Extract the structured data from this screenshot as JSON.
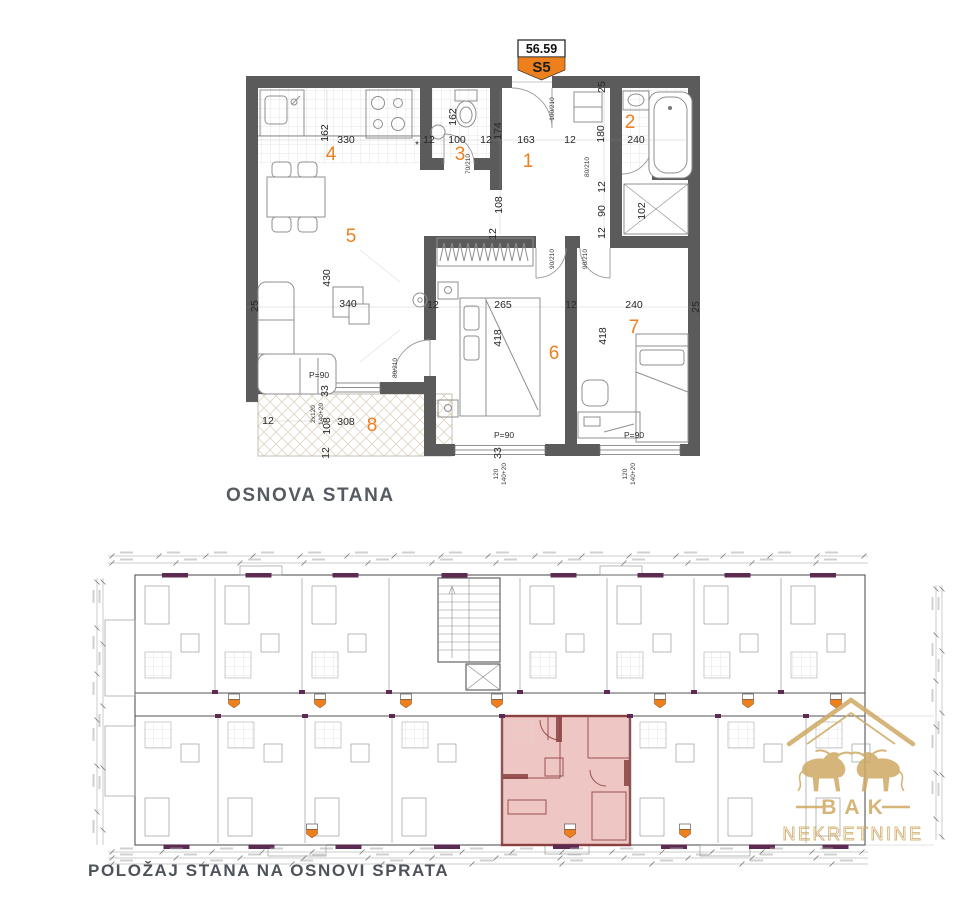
{
  "titles": {
    "plan": "OSNOVA STANA",
    "site": "POLOŽAJ STANA NA OSNOVI SPRATA"
  },
  "badge": {
    "area": "56.59",
    "unit": "S5"
  },
  "logo": {
    "name": "BAK",
    "subtitle": "NEKRETNINE"
  },
  "colors": {
    "accent_orange": "#ee7f1d",
    "wall_gray": "#5b5b5b",
    "highlight_pink": "#dd8e88",
    "highlight_wall": "#8a4040",
    "purple_accent": "#5d2b52",
    "logo_gold": "#cfa963",
    "title_gray": "#565a61"
  },
  "floorplan": {
    "labels": [
      {
        "t": "330",
        "x": 346,
        "y": 143,
        "k": "d"
      },
      {
        "t": "162",
        "x": 328,
        "y": 133,
        "k": "d",
        "r": 1
      },
      {
        "t": "*",
        "x": 417,
        "y": 148,
        "k": "d"
      },
      {
        "t": "12",
        "x": 429,
        "y": 143,
        "k": "d"
      },
      {
        "t": "100",
        "x": 457,
        "y": 143,
        "k": "d"
      },
      {
        "t": "12",
        "x": 486,
        "y": 143,
        "k": "d"
      },
      {
        "t": "162",
        "x": 456,
        "y": 117,
        "k": "d",
        "r": 1
      },
      {
        "t": "174",
        "x": 501,
        "y": 131,
        "k": "d",
        "r": 1
      },
      {
        "t": "163",
        "x": 526,
        "y": 143,
        "k": "d"
      },
      {
        "t": "25",
        "x": 605,
        "y": 87,
        "k": "d",
        "r": 1
      },
      {
        "t": "180",
        "x": 604,
        "y": 134,
        "k": "d",
        "r": 1
      },
      {
        "t": "240",
        "x": 636,
        "y": 143,
        "k": "d"
      },
      {
        "t": "12",
        "x": 570,
        "y": 143,
        "k": "d"
      },
      {
        "t": "12",
        "x": 605,
        "y": 187,
        "k": "d",
        "r": 1
      },
      {
        "t": "90",
        "x": 605,
        "y": 211,
        "k": "d",
        "r": 1
      },
      {
        "t": "12",
        "x": 605,
        "y": 233,
        "k": "d",
        "r": 1
      },
      {
        "t": "102",
        "x": 645,
        "y": 211,
        "k": "d",
        "r": 1
      },
      {
        "t": "108",
        "x": 502,
        "y": 205,
        "k": "d",
        "r": 1
      },
      {
        "t": "12",
        "x": 496,
        "y": 234,
        "k": "d",
        "r": 1
      },
      {
        "t": "25",
        "x": 258,
        "y": 306,
        "k": "d",
        "r": 1
      },
      {
        "t": "430",
        "x": 330,
        "y": 278,
        "k": "d",
        "r": 1
      },
      {
        "t": "340",
        "x": 348,
        "y": 307,
        "k": "d"
      },
      {
        "t": "12",
        "x": 433,
        "y": 308,
        "k": "d"
      },
      {
        "t": "265",
        "x": 503,
        "y": 308,
        "k": "d"
      },
      {
        "t": "12",
        "x": 571,
        "y": 308,
        "k": "d"
      },
      {
        "t": "240",
        "x": 634,
        "y": 308,
        "k": "d"
      },
      {
        "t": "25",
        "x": 699,
        "y": 307,
        "k": "d",
        "r": 1
      },
      {
        "t": "418",
        "x": 501,
        "y": 338,
        "k": "d",
        "r": 1
      },
      {
        "t": "418",
        "x": 606,
        "y": 336,
        "k": "d",
        "r": 1
      },
      {
        "t": "12",
        "x": 268,
        "y": 424,
        "k": "d"
      },
      {
        "t": "108",
        "x": 330,
        "y": 426,
        "k": "d",
        "r": 1
      },
      {
        "t": "308",
        "x": 346,
        "y": 425,
        "k": "d"
      },
      {
        "t": "12",
        "x": 329,
        "y": 453,
        "k": "d",
        "r": 1
      },
      {
        "t": "33",
        "x": 328,
        "y": 391,
        "k": "d",
        "r": 1
      },
      {
        "t": "33",
        "x": 501,
        "y": 453,
        "k": "d",
        "r": 1
      },
      {
        "t": "70/210",
        "x": 470,
        "y": 164,
        "k": "o",
        "r": 1
      },
      {
        "t": "100/210",
        "x": 554,
        "y": 109,
        "k": "o",
        "r": 1
      },
      {
        "t": "80/210",
        "x": 589,
        "y": 167,
        "k": "o",
        "r": 1
      },
      {
        "t": "90/210",
        "x": 554,
        "y": 259,
        "k": "o",
        "r": 1
      },
      {
        "t": "90/210",
        "x": 587,
        "y": 259,
        "k": "o",
        "r": 1
      },
      {
        "t": "80/210",
        "x": 397,
        "y": 368,
        "k": "o",
        "r": 1
      },
      {
        "t": "P=90",
        "x": 319,
        "y": 378,
        "k": "n"
      },
      {
        "t": "P=90",
        "x": 504,
        "y": 438,
        "k": "n"
      },
      {
        "t": "P=90",
        "x": 634,
        "y": 438,
        "k": "n"
      },
      {
        "t": "2x120",
        "x": 315,
        "y": 414,
        "k": "o",
        "r": 1
      },
      {
        "t": "140+20",
        "x": 323,
        "y": 414,
        "k": "o",
        "r": 1
      },
      {
        "t": "120",
        "x": 498,
        "y": 474,
        "k": "o",
        "r": 1
      },
      {
        "t": "140+20",
        "x": 506,
        "y": 474,
        "k": "o",
        "r": 1
      },
      {
        "t": "120",
        "x": 627,
        "y": 474,
        "k": "o",
        "r": 1
      },
      {
        "t": "140+20",
        "x": 635,
        "y": 474,
        "k": "o",
        "r": 1
      },
      {
        "t": "1",
        "x": 528,
        "y": 167,
        "k": "m"
      },
      {
        "t": "2",
        "x": 630,
        "y": 128,
        "k": "m"
      },
      {
        "t": "3",
        "x": 460,
        "y": 160,
        "k": "m"
      },
      {
        "t": "4",
        "x": 331,
        "y": 160,
        "k": "m"
      },
      {
        "t": "5",
        "x": 351,
        "y": 242,
        "k": "m"
      },
      {
        "t": "6",
        "x": 554,
        "y": 359,
        "k": "m"
      },
      {
        "t": "7",
        "x": 634,
        "y": 333,
        "k": "m"
      },
      {
        "t": "8",
        "x": 372,
        "y": 431,
        "k": "m"
      }
    ]
  }
}
